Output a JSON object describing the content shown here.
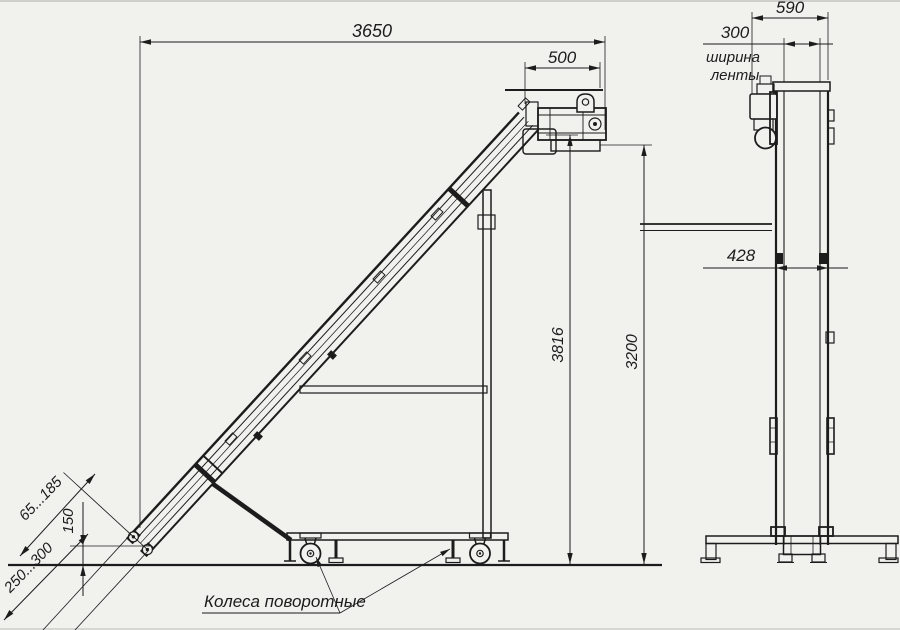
{
  "colors": {
    "background": "#f1f1ee",
    "line": "#1c1c1c"
  },
  "dimensions": {
    "overall_length": "3650",
    "head_section_length": "500",
    "overall_width": "590",
    "belt_width": "300",
    "belt_width_note_line1": "ширина",
    "belt_width_note_line2": "ленты",
    "frame_width": "428",
    "total_height": "3816",
    "discharge_height": "3200",
    "infeed_range": "65...185",
    "infeed_height": "150",
    "tail_range": "250...300"
  },
  "annotations": {
    "casters": "Колеса поворотные"
  }
}
